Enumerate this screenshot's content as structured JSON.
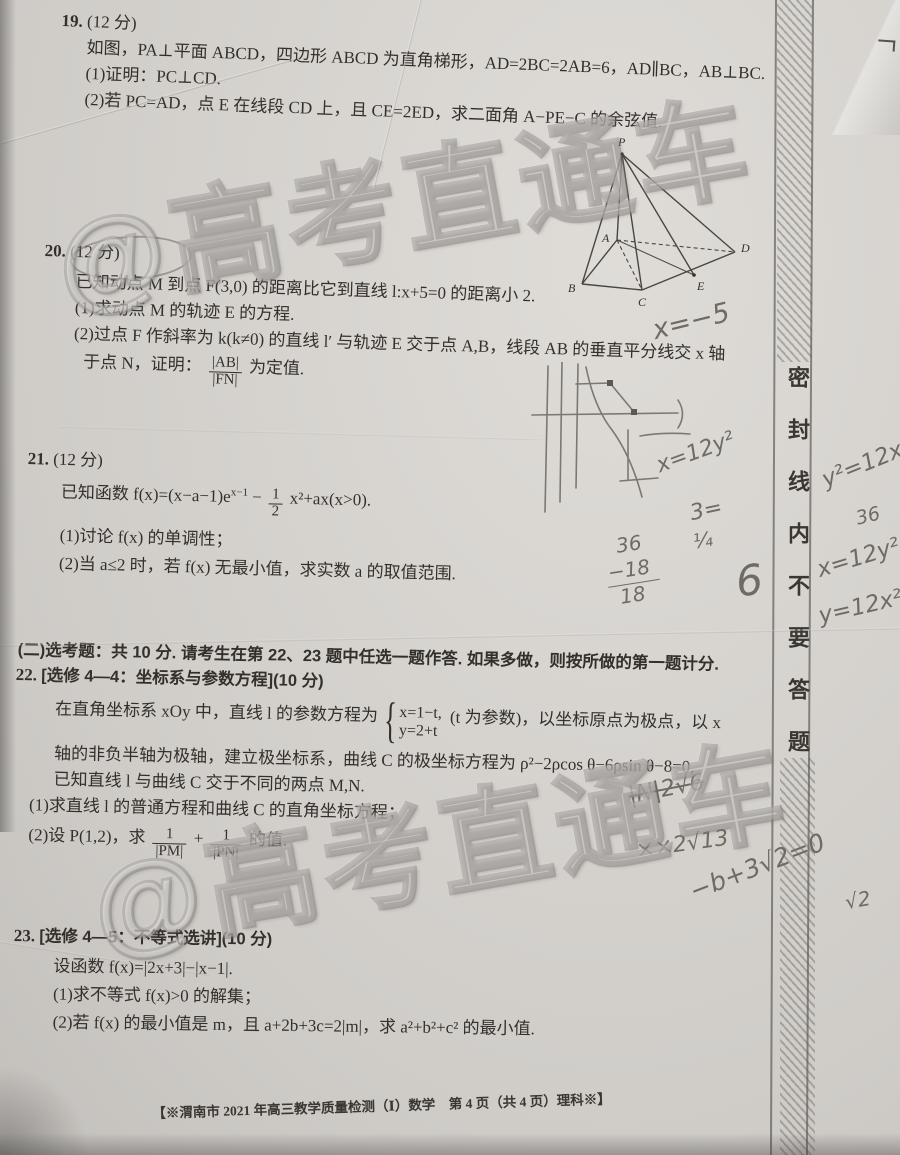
{
  "page": {
    "footer": "【※渭南市 2021 年高三教学质量检测（Ⅰ）数学　第 4 页（共 4 页）理科※】"
  },
  "watermark": {
    "text": "@高考直通车"
  },
  "seal_strip": {
    "text": "密封线内不要答题"
  },
  "q19": {
    "num": "19.",
    "points": "(12 分)",
    "line1": "如图，PA⊥平面 ABCD，四边形 ABCD 为直角梯形，AD=2BC=2AB=6，AD∥BC，AB⊥BC.",
    "item1": "(1)证明：PC⊥CD.",
    "item2": "(2)若 PC=AD，点 E 在线段 CD 上，且 CE=2ED，求二面角 A−PE−C 的余弦值.",
    "figure_labels": {
      "P": "P",
      "A": "A",
      "B": "B",
      "C": "C",
      "D": "D",
      "E": "E"
    }
  },
  "q20": {
    "num": "20.",
    "points": "(12 分)",
    "line1": "已知动点 M 到点 F(3,0) 的距离比它到直线 l:x+5=0 的距离小 2.",
    "item1": "(1)求动点 M 的轨迹 E 的方程.",
    "item2a": "(2)过点 F 作斜率为 k(k≠0) 的直线 l′ 与轨迹 E 交于点 A,B，线段 AB 的垂直平分线交 x 轴",
    "item2b_prefix": "于点 N，证明：",
    "frac_num": "|AB|",
    "frac_den": "|FN|",
    "item2b_suffix": "为定值."
  },
  "q21": {
    "num": "21.",
    "points": "(12 分)",
    "line1_pre": "已知函数 f(x)=(x−a−1)e",
    "line1_sup": "x−1",
    "line1_mid": "−",
    "frac_num": "1",
    "frac_den": "2",
    "line1_suf": "x²+ax(x>0).",
    "item1": "(1)讨论 f(x) 的单调性；",
    "item2": "(2)当 a≤2 时，若 f(x) 无最小值，求实数 a 的取值范围."
  },
  "section2": {
    "line": "(二)选考题：共 10 分. 请考生在第 22、23 题中任选一题作答. 如果多做，则按所做的第一题计分."
  },
  "q22": {
    "num": "22.",
    "title": "[选修 4—4：坐标系与参数方程](10 分)",
    "line1_pre": "在直角坐标系 xOy 中，直线 l 的参数方程为",
    "case1": "x=1−t,",
    "case2": "y=2+t",
    "line1_suf": "(t 为参数)，以坐标原点为极点，以 x",
    "line2": "轴的非负半轴为极轴，建立极坐标系，曲线 C 的极坐标方程为 ρ²−2ρcos θ−6ρsin θ−8=0,",
    "line3": "已知直线 l 与曲线 C 交于不同的两点 M,N.",
    "item1": "(1)求直线 l 的普通方程和曲线 C 的直角坐标方程；",
    "item2_pre": "(2)设 P(1,2)，求",
    "frac1_num": "1",
    "frac1_den": "|PM|",
    "plus": "+",
    "frac2_num": "1",
    "frac2_den": "|PN|",
    "item2_suf": "的值."
  },
  "q23": {
    "num": "23.",
    "title": "[选修 4—5：不等式选讲](10 分)",
    "line1": "设函数 f(x)=|2x+3|−|x−1|.",
    "item1": "(1)求不等式 f(x)>0 的解集；",
    "item2": "(2)若 f(x) 的最小值是 m，且 a+2b+3c=2|m|，求 a²+b²+c² 的最小值."
  },
  "handwriting": {
    "hw_xminus5": "x=−5",
    "hw_x12y2_a": "x=12y²",
    "hw_3eq": "3=",
    "hw_quarter": "¼",
    "hw_36a": "36",
    "hw_neg18": "−18",
    "hw_18": "18",
    "hw_6": "6",
    "hw_y2_12x": "y²=12x",
    "hw_36b": "36",
    "hw_x12y2_b": "x=12y²",
    "hw_y12x2": "y=12x²",
    "hw_n2r6": "|N|2√6",
    "hw_xx2r13": "××2√13",
    "hw_b3r2": "−b+3√2=0",
    "hw_r2": "√2"
  }
}
